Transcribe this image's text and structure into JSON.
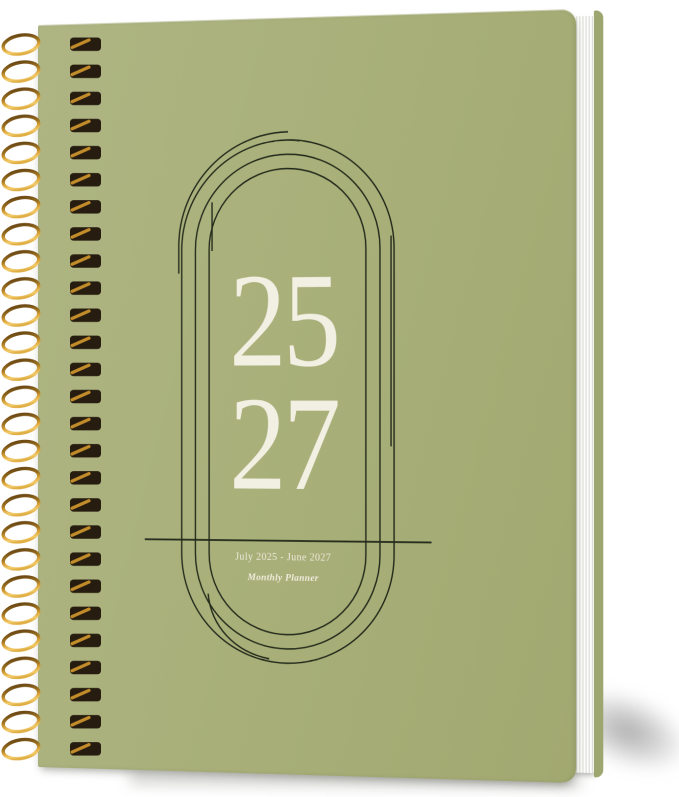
{
  "product": {
    "title_year_top": "25",
    "title_year_bottom": "27",
    "date_range": "July 2025 - June 2027",
    "subtitle": "Monthly Planner"
  },
  "binding": {
    "style": "gold double-wire spiral",
    "coil_count": 27
  },
  "colors": {
    "cover_green": "#a9b07a",
    "line_dark": "#232a1b",
    "text_cream": "#f2f0e3",
    "wire_gold": "#d9a63a",
    "page_edge_white": "#fcfcfa",
    "back_cover_edge": "#9da66f"
  }
}
